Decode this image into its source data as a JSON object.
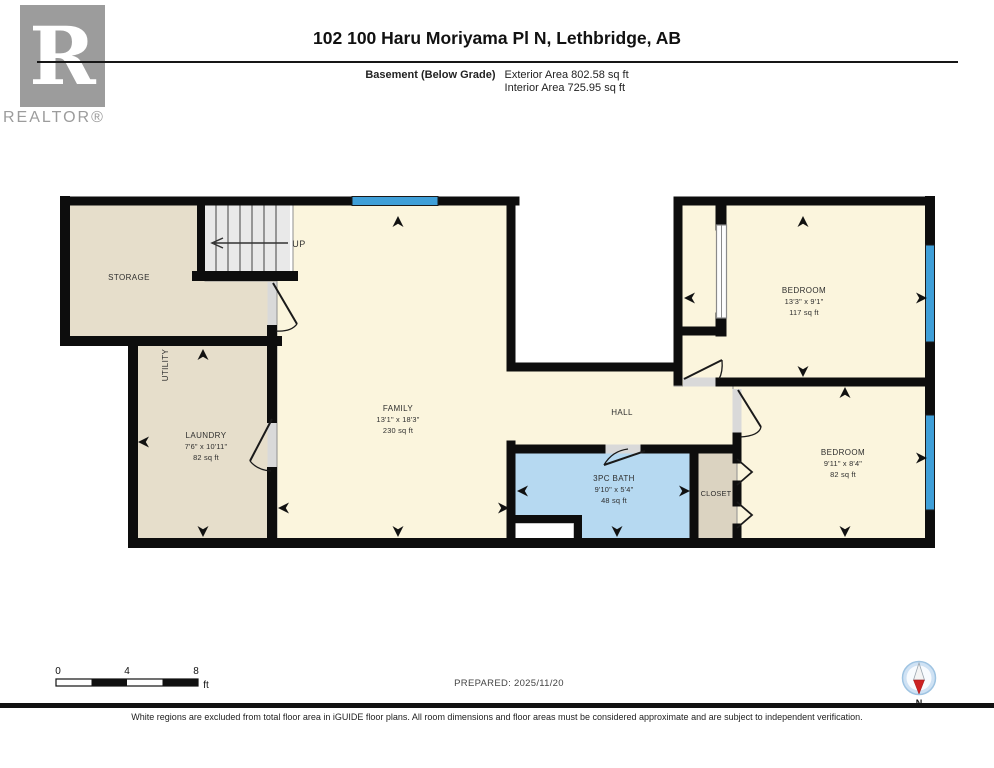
{
  "header": {
    "title": "102 100 Haru Moriyama Pl N, Lethbridge, AB",
    "floor_label": "Basement (Below Grade)",
    "exterior_area": "Exterior Area 802.58 sq ft",
    "interior_area": "Interior Area 725.95 sq ft"
  },
  "logo": {
    "letter": "R",
    "brand": "REALTOR®"
  },
  "plan": {
    "stairs_label": "UP",
    "rooms": {
      "storage": {
        "name": "STORAGE"
      },
      "utility": {
        "name": "UTILITY"
      },
      "laundry": {
        "name": "LAUNDRY",
        "dims": "7'6\" x 10'11\"",
        "area": "82 sq ft"
      },
      "family": {
        "name": "FAMILY",
        "dims": "13'1\" x 18'3\"",
        "area": "230 sq ft"
      },
      "hall": {
        "name": "HALL"
      },
      "bedroom_right": {
        "name": "BEDROOM",
        "dims": "13'3\" x 9'1\"",
        "area": "117 sq ft"
      },
      "bedroom_bottom": {
        "name": "BEDROOM",
        "dims": "9'11\" x 8'4\"",
        "area": "82 sq ft"
      },
      "bath": {
        "name": "3PC BATH",
        "dims": "9'10\" x 5'4\"",
        "area": "48 sq ft"
      },
      "closet": {
        "name": "CLOSET"
      }
    }
  },
  "footer": {
    "scale": {
      "t0": "0",
      "t4": "4",
      "t8": "8",
      "unit": "ft"
    },
    "prepared": "PREPARED: 2025/11/20",
    "compass": "N",
    "disclaimer": "White regions are excluded from total floor area in iGUIDE floor plans. All room dimensions and floor areas must be considered approximate and are subject to independent verification."
  },
  "colors": {
    "room_cream": "#fbf5dd",
    "room_tan": "#e6decb",
    "bath_blue": "#b6d9f1",
    "closet_tan": "#dbd3c1",
    "stair_gray": "#e9e9e9",
    "window_blue": "#3f9fd8",
    "wall": "#0d0d0d"
  }
}
